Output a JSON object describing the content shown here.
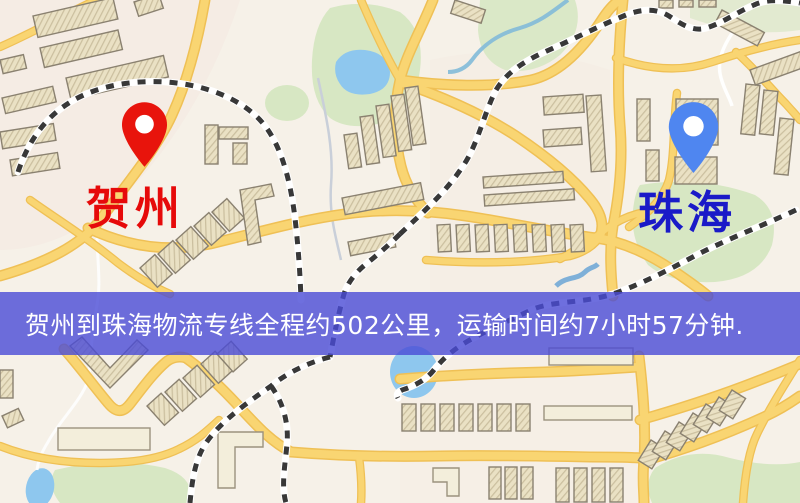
{
  "map": {
    "type": "road-map",
    "markers": {
      "origin": {
        "name": "origin-pin",
        "label": "贺州",
        "pin_color": "#e8140c",
        "label_color": "#e60a0a"
      },
      "destination": {
        "name": "destination-pin",
        "label": "珠海",
        "pin_color": "#4f86f0",
        "label_color": "#1a1ac8"
      }
    }
  },
  "banner": {
    "text": "贺州到珠海物流专线全程约502公里，运输时间约7小时57分钟.",
    "distance_km": "502",
    "duration": "7小时57分钟",
    "background_color": "#4a4bd6",
    "text_color": "#ffffff"
  },
  "palette": {
    "land": "#f6f1e8",
    "road_fill": "#f9d572",
    "road_edge": "#efc055",
    "park": "#d7e7c3",
    "water": "#8ec7ee",
    "building": "#eae1c4",
    "railway": "#383838"
  }
}
